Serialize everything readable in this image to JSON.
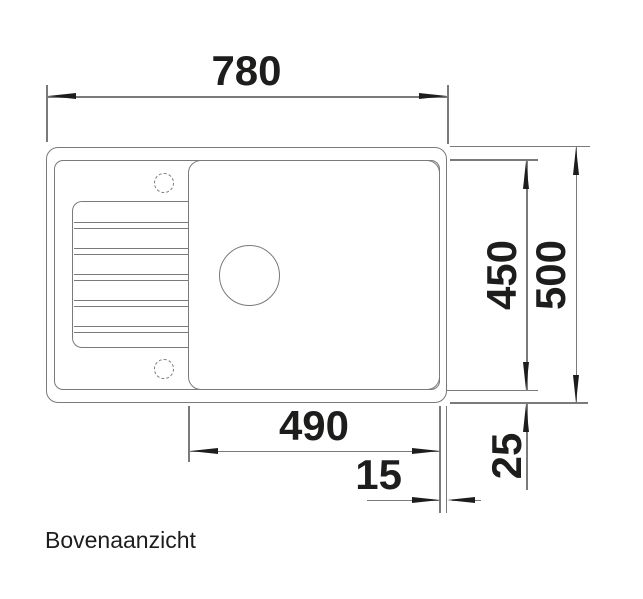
{
  "drawing": {
    "caption": "Bovenaanzicht",
    "dims": {
      "overall_width": "780",
      "overall_depth": "500",
      "inner_depth": "450",
      "bowl_width": "490",
      "rim_right": "15",
      "rim_bottom": "25"
    },
    "colors": {
      "line": "#7a7a7a",
      "ink": "#1d1d1b",
      "bg": "#ffffff"
    }
  }
}
